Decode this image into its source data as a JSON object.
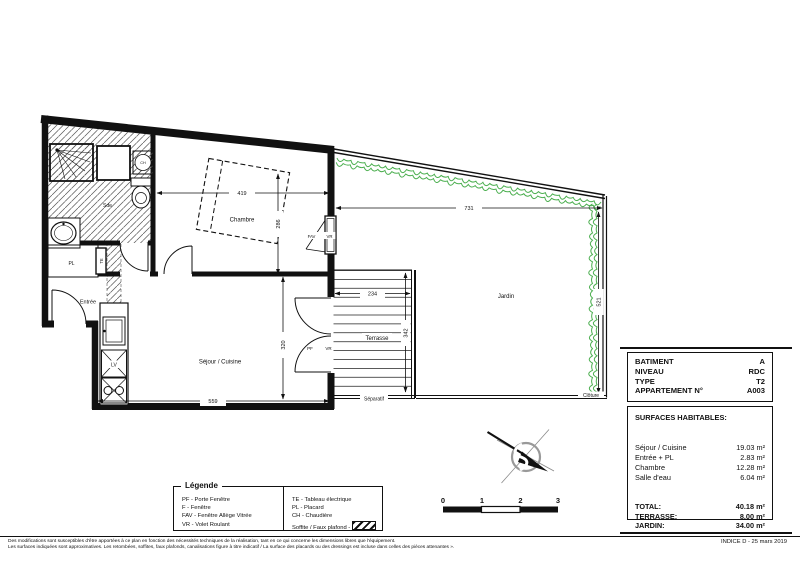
{
  "plan": {
    "rooms": {
      "sde": "Sde",
      "chambre": "Chambre",
      "entree": "Entrée",
      "sejour": "Séjour / Cuisine",
      "terrasse": "Terrasse",
      "jardin": "Jardin"
    },
    "fixtures": {
      "pl": "PL",
      "te": "TE",
      "ch": "CH",
      "lv": "LV"
    },
    "openings": {
      "fav": "FAV",
      "vr_chambre": "VR",
      "pf": "PF",
      "vr_sejour": "VR"
    },
    "site": {
      "separatif": "Séparatif",
      "cloture": "Clôture"
    },
    "dimensions": {
      "chambre_w": "419",
      "chambre_h": "286",
      "sejour_w": "559",
      "sejour_h": "320",
      "terrasse_w": "234",
      "terrasse_h": "342",
      "jardin_w": "731",
      "jardin_h": "521"
    }
  },
  "title_block": {
    "rows": [
      {
        "label": "BATIMENT",
        "value": "A"
      },
      {
        "label": "NIVEAU",
        "value": "RDC"
      },
      {
        "label": "TYPE",
        "value": "T2"
      },
      {
        "label": "APPARTEMENT N°",
        "value": "A003"
      }
    ],
    "surfaces_title": "SURFACES HABITABLES:",
    "surfaces": [
      {
        "label": "Séjour / Cuisine",
        "value": "19.03 m²"
      },
      {
        "label": "Entrée + PL",
        "value": "2.83 m²"
      },
      {
        "label": "Chambre",
        "value": "12.28 m²"
      },
      {
        "label": "Salle d'eau",
        "value": "6.04 m²"
      }
    ],
    "totals": [
      {
        "label": "TOTAL:",
        "value": "40.18 m²"
      },
      {
        "label": "TERRASSE:",
        "value": "8.00 m²"
      },
      {
        "label": "JARDIN:",
        "value": "34.00 m²"
      }
    ]
  },
  "legend": {
    "title": "Légende",
    "col1": [
      "PF - Porte Fenêtre",
      "F - Fenêtre",
      "FAV - Fenêtre Allège Vitrée",
      "VR - Volet Roulant"
    ],
    "col2": [
      "TE - Tableau électrique",
      "PL - Placard",
      "CH - Chaudière",
      "Soffite / Faux plafond -"
    ]
  },
  "scale_bar": {
    "ticks": [
      "0",
      "1",
      "2",
      "3"
    ]
  },
  "footer": {
    "line1": "Des modifications sont susceptibles d'être apportées à ce plan en fonction des nécessités techniques de la réalisation, tant en ce qui concerne les dimensions libres que l'équipement.",
    "line2": "Les surfaces indiquées sont approximatives. Les retombées, soffites, faux plafonds, canalisations figure à titre indicatif / La surface des placards ou des dressings est incluse dans celles des pièces attenantes ».",
    "indice": "INDICE D - 25 mars 2019"
  },
  "colors": {
    "hedge": "#4caf50",
    "line": "#111111",
    "compass_gray": "#999999"
  }
}
